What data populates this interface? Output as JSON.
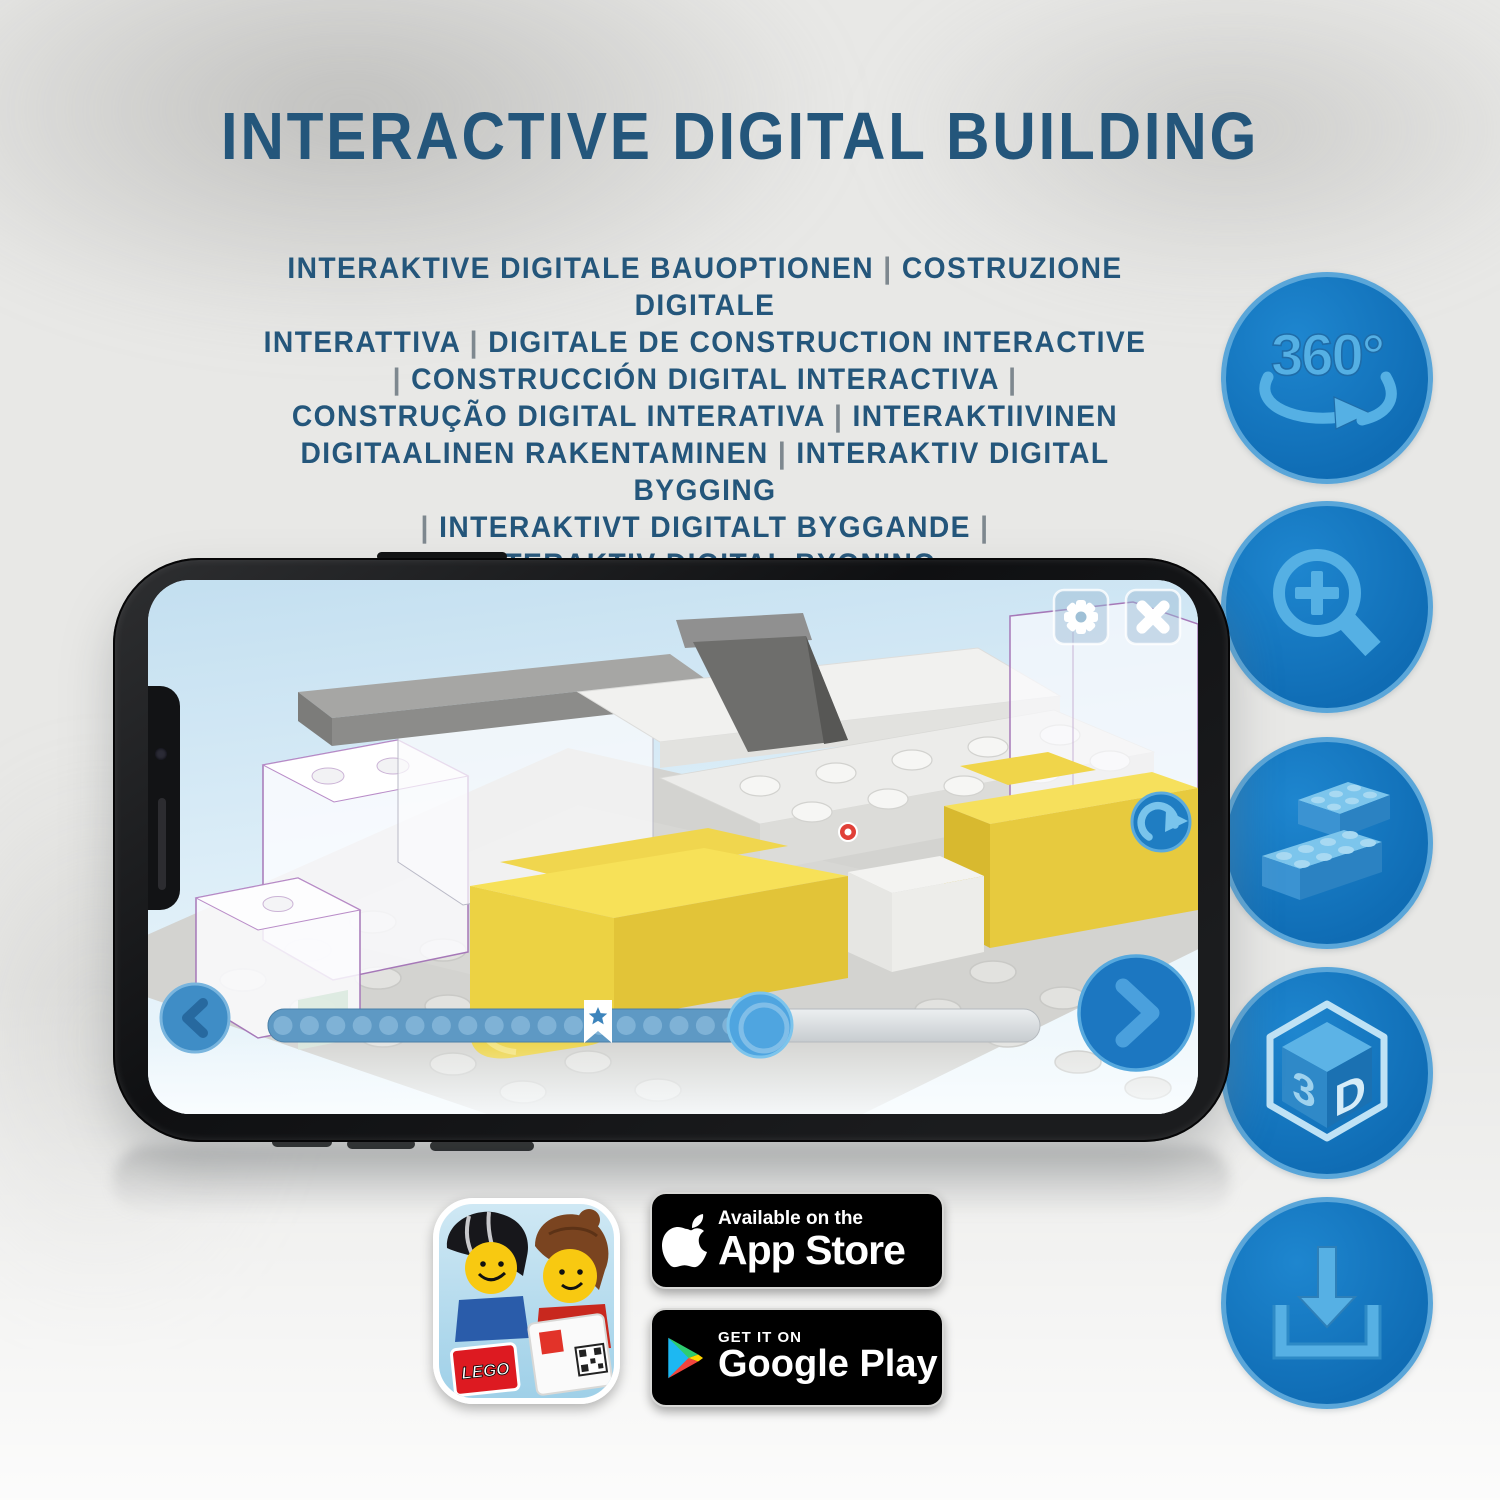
{
  "title": "INTERACTIVE DIGITAL BUILDING",
  "subtitle_lines": [
    "INTERAKTIVE DIGITALE BAUOPTIONEN | COSTRUZIONE DIGITALE",
    "INTERATTIVA | DIGITALE DE CONSTRUCTION INTERACTIVE",
    "| CONSTRUCCIÓN DIGITAL INTERACTIVA |",
    "CONSTRUÇÃO DIGITAL INTERATIVA | INTERAKTIIVINEN",
    "DIGITAALINEN RAKENTAMINEN | INTERAKTIV DIGITAL BYGGING",
    "| INTERAKTIVT DIGITALT BYGGANDE |",
    "INTERAKTIV DIGITAL BYGNING"
  ],
  "feature_icons": {
    "rotation_360": {
      "label": "360°"
    },
    "cube_3d": {
      "face_left": "3",
      "face_right": "D"
    }
  },
  "phone": {
    "app_ui": {
      "slider": {
        "dots": 18,
        "progress_percent": 64,
        "bookmark_percent": 43
      }
    }
  },
  "store_badges": {
    "app_store": {
      "tagline": "Available on the",
      "store": "App Store"
    },
    "google_play": {
      "tagline": "GET IT ON",
      "store": "Google Play"
    },
    "lego_app_icon": {
      "logo": "LEGO"
    }
  },
  "colors": {
    "headline_blue": "#24567b",
    "accent_blue": "#1278c0",
    "icon_glyph_blue": "#55b0e4",
    "slider_fill": "#5e99c4",
    "yellow_brick": "#f6e05c",
    "purple_outline": "#a678b8"
  }
}
